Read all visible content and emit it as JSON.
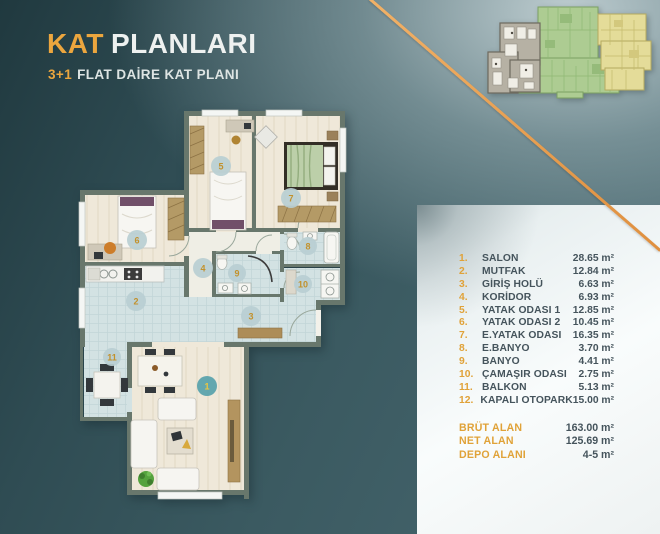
{
  "header": {
    "title_accent": "KAT",
    "title_rest": "PLANLARI",
    "subtitle_accent": "3+1",
    "subtitle_rest": "FLAT DAİRE KAT PLANI"
  },
  "rooms": {
    "items": [
      {
        "no": "1.",
        "label": "SALON",
        "area": "28.65 m²"
      },
      {
        "no": "2.",
        "label": "MUTFAK",
        "area": "12.84 m²"
      },
      {
        "no": "3.",
        "label": "GİRİŞ HOLÜ",
        "area": "6.63 m²"
      },
      {
        "no": "4.",
        "label": "KORİDOR",
        "area": "6.93 m²"
      },
      {
        "no": "5.",
        "label": "YATAK ODASI 1",
        "area": "12.85 m²"
      },
      {
        "no": "6.",
        "label": "YATAK ODASI 2",
        "area": "10.45 m²"
      },
      {
        "no": "7.",
        "label": "E.YATAK ODASI",
        "area": "16.35 m²"
      },
      {
        "no": "8.",
        "label": "E.BANYO",
        "area": "3.70 m²"
      },
      {
        "no": "9.",
        "label": "BANYO",
        "area": "4.41 m²"
      },
      {
        "no": "10.",
        "label": "ÇAMAŞIR ODASI",
        "area": "2.75 m²"
      },
      {
        "no": "11.",
        "label": "BALKON",
        "area": "5.13 m²"
      },
      {
        "no": "12.",
        "label": "KAPALI OTOPARK",
        "area": "15.00 m²"
      }
    ]
  },
  "totals": {
    "items": [
      {
        "label": "BRÜT ALAN",
        "value": "163.00 m²"
      },
      {
        "label": "NET ALAN",
        "value": "125.69 m²"
      },
      {
        "label": "DEPO ALANI",
        "value": "4-5 m²"
      }
    ]
  },
  "plan": {
    "badges": [
      "1",
      "2",
      "3",
      "4",
      "5",
      "6",
      "7",
      "8",
      "9",
      "10",
      "11"
    ]
  },
  "colors": {
    "accent_orange": "#ECA63E",
    "background_teal": "#3B5A61",
    "panel_white": "#F6FAFA",
    "overview_unit_green": "#ADCC92",
    "overview_unit_yellow": "#E4DC99",
    "overview_unit_gray": "#B6B1A4"
  }
}
